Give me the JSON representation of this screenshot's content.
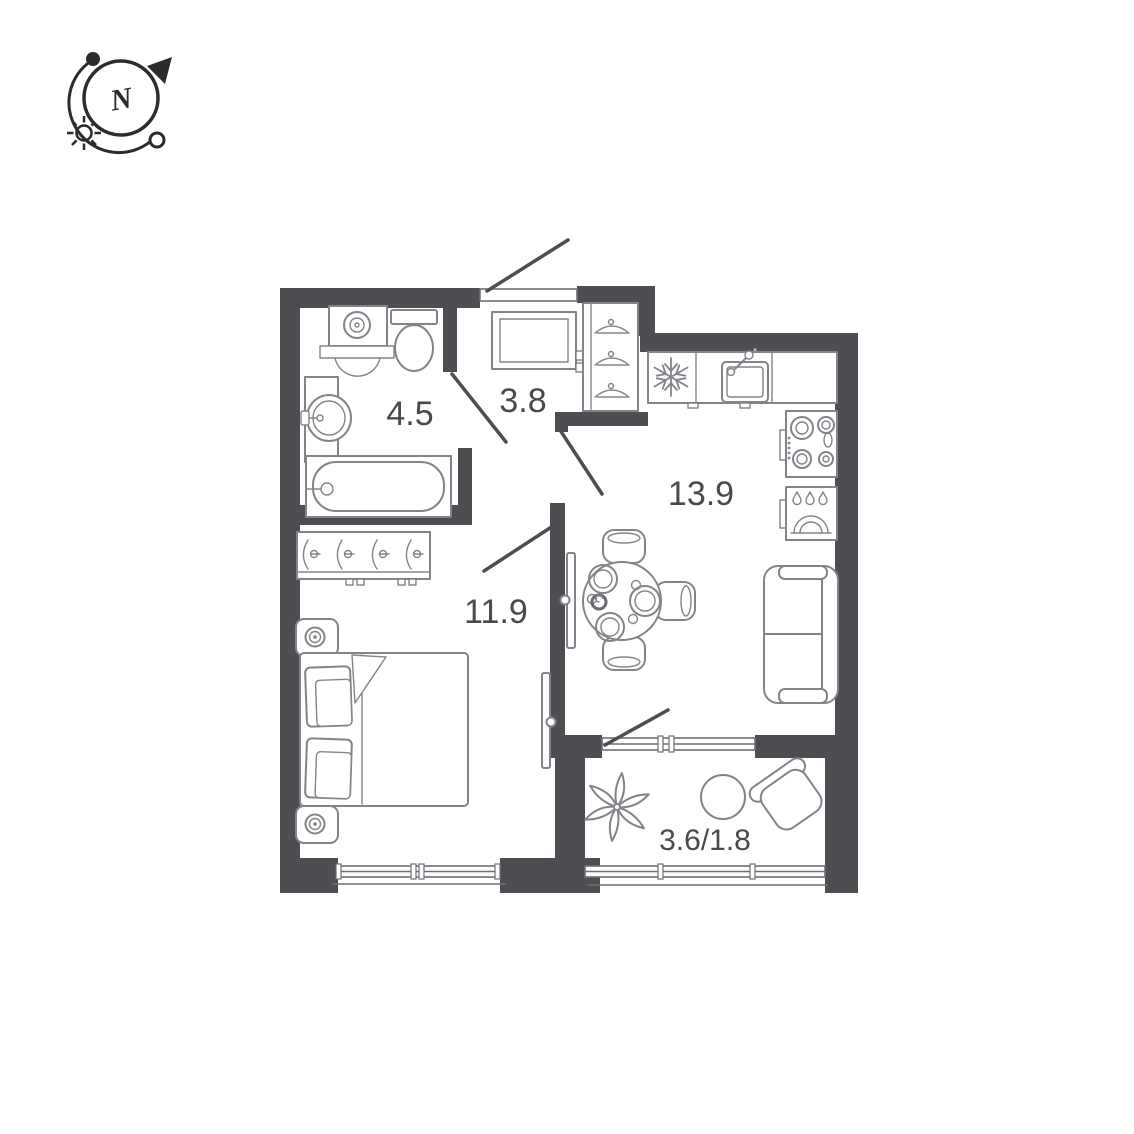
{
  "compass": {
    "north_label": "N",
    "icons": [
      "north-arrow-icon",
      "sun-icon",
      "orbit-arc-icon"
    ]
  },
  "rooms": [
    {
      "id": "bathroom",
      "area_label": "4.5",
      "furniture": [
        "washing-machine",
        "toilet",
        "wash-basin",
        "bathtub"
      ]
    },
    {
      "id": "hallway",
      "area_label": "3.8",
      "furniture": [
        "mirror",
        "wardrobe-front-hangers"
      ]
    },
    {
      "id": "kitchen-living",
      "area_label": "13.9",
      "furniture": [
        "fridge",
        "kitchen-sink",
        "stove",
        "dishwasher",
        "dining-table",
        "chairs",
        "sofa"
      ]
    },
    {
      "id": "bedroom",
      "area_label": "11.9",
      "furniture": [
        "wardrobe-side-hangers",
        "nightstand-lamp",
        "double-bed"
      ]
    },
    {
      "id": "balcony",
      "area_label": "3.6/1.8",
      "furniture": [
        "plant",
        "coffee-table",
        "armchair"
      ]
    }
  ],
  "colors": {
    "wall": "#4d4d52",
    "furniture_stroke": "#83838a",
    "label_text": "#4a4a4a",
    "compass_ink": "#2c2c2f",
    "background": "#ffffff"
  }
}
